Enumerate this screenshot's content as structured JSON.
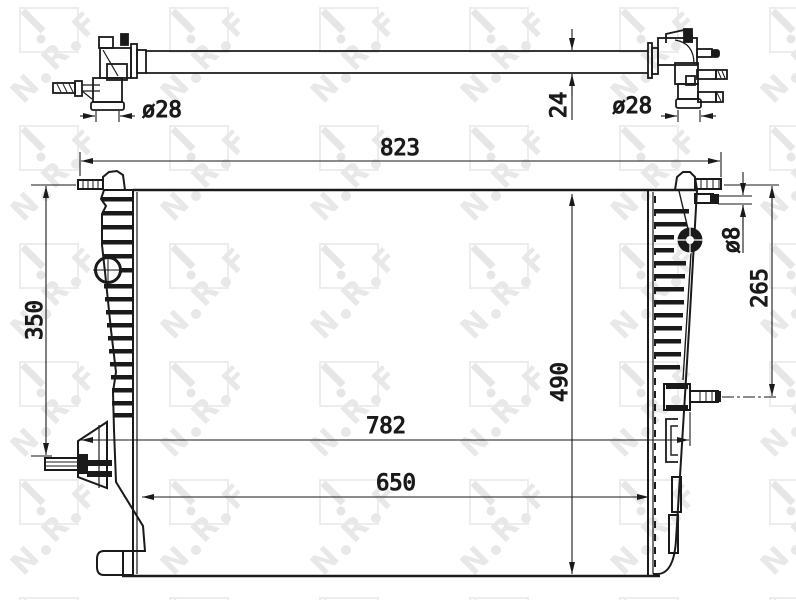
{
  "drawing": {
    "kind": "technical-drawing",
    "subject": "radiator-with-inlet-pipes",
    "watermark": {
      "letters": [
        "N",
        "R",
        "F"
      ]
    },
    "dims": {
      "overall_width": "823",
      "pin_span_width": "782",
      "core_width": "650",
      "core_height": "490",
      "left_pin_spacing": "350",
      "right_pin_spacing": "265",
      "tube_depth": "24",
      "port_dia_left": "ø28",
      "port_dia_right": "ø28",
      "pin_dia": "ø8"
    }
  }
}
